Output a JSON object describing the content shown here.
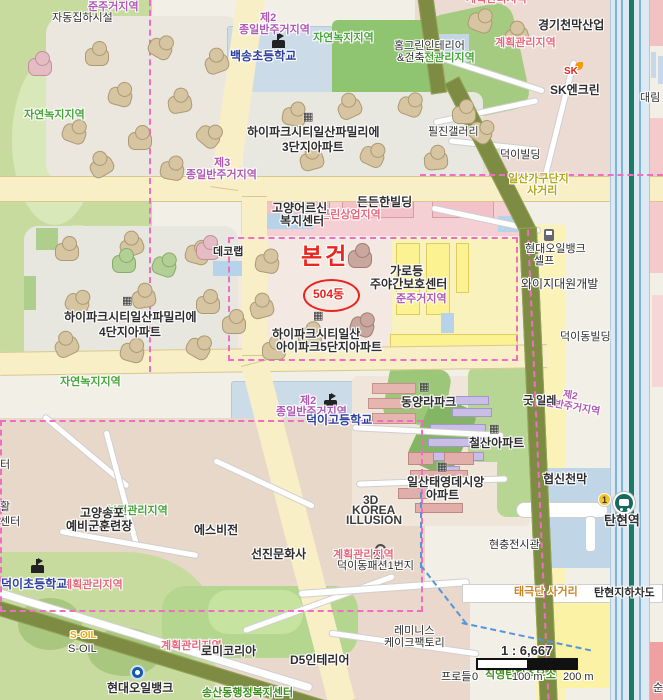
{
  "map": {
    "subject": {
      "title": "본건",
      "unit": "504동"
    },
    "zones": {
      "junju_topleft": "준주거지역",
      "j2_top_no": "제2",
      "j2_top": "종일반주거지역",
      "yn_top": "자연녹지지역",
      "yn_left": "자연녹지지역",
      "yn_mid": "자연녹지지역",
      "j3_no": "제3",
      "j3": "종일반주거지역",
      "geunrin": "근린상업지역",
      "junju_center": "준주거지역",
      "gyehoek_topcut": "계획관리지역",
      "gyehoek_tr": "계획관리지역",
      "bojeon_tr": "보전관리지역",
      "j2_school_no": "제2",
      "j2_school": "종일반주거지역",
      "j2_right_no": "제2",
      "j2_right": "종일반주거지역",
      "bojeon_bl": "보전관리지역",
      "gyehoek_school": "계획관리지역",
      "gyehoek_fashion": "계획관리지역",
      "gyehoek_bottom": "계획관리지역"
    },
    "pois": {
      "jadong": "자동집하시설",
      "baeksong": "백송초등학교",
      "homegreen1": "홈그린인테리어",
      "homegreen2": "&건축",
      "ggtent": "경기천막산업",
      "sk_logo": "SK",
      "sk": "SK엔크린",
      "daelim": "대림",
      "hipark3_1": "하이파크시티일산파밀리에",
      "hipark3_2": "3단지아파트",
      "piljin": "필진갤러리",
      "deokyi_bldg": "덕이빌딩",
      "hyundai_r1": "현대오일뱅크",
      "hyundai_r2": "셀프",
      "yg": "와이지대원개발",
      "deokyidong_bldg": "덕이동빌딩",
      "decolab": "데코랩",
      "hipark4_1": "하이파크시티일산파밀리에",
      "hipark4_2": "4단지아파트",
      "elder1": "고양어르신",
      "elder2": "복지센터",
      "dndn": "든든한빌딩",
      "garo1": "가로등",
      "garo2": "주야간보호센터",
      "hipark5_1": "하이파크시티일산",
      "hipark5_2": "아이파크5단지아파트",
      "dhigh": "덕이고등학교",
      "dongyang": "동양라파크",
      "cheolsan": "철산아파트",
      "good": "굿 일레",
      "taeyoung1": "일산태영데시앙",
      "taeyoung2": "아파트",
      "hyupsin": "협신천막",
      "hyeonchung": "현충전시관",
      "illusion1": "3D",
      "illusion2": "KOREA",
      "illusion3": "ILLUSION",
      "seonjin": "선진문화사",
      "esvision": "에스비전",
      "fashion": "덕이동패션1번지",
      "songpo1": "고양송포",
      "songpo2": "예비군훈련장",
      "delem": "덕이초등학교",
      "soil_logo": "S-OIL",
      "soil": "S-OIL",
      "hyundai_b": "현대오일뱅크",
      "romi": "로미코리아",
      "songsan": "송산동행정복지센터",
      "reminis1": "레미니스",
      "reminis2": "케이크팩토리",
      "d5": "D5인테리어",
      "prodeul": "프로들",
      "jikyeong": "직영탄현주유소",
      "p_teo": "터",
      "p_hwal": "활",
      "p_center": "센터",
      "p_sun": "순"
    },
    "roads": {
      "furniture1": "일산가구단지",
      "furniture2": "사거리",
      "taegeuk": "태극단 사거리",
      "underpass": "탄현지하차도"
    },
    "transit": {
      "station": "탄현역",
      "badge": "1"
    },
    "scale": {
      "ratio": "1 : 6,667",
      "s0": "0",
      "s100": "100 m",
      "s200": "200 m"
    },
    "icons": {
      "apartment": "▦"
    },
    "colors": {
      "subject": "#e8251f",
      "zone_residential": "#b05ab5",
      "zone_management": "#e8697d",
      "zone_green": "#49a53b",
      "school_text": "#2c3e9e",
      "station": "#176b5e"
    }
  }
}
